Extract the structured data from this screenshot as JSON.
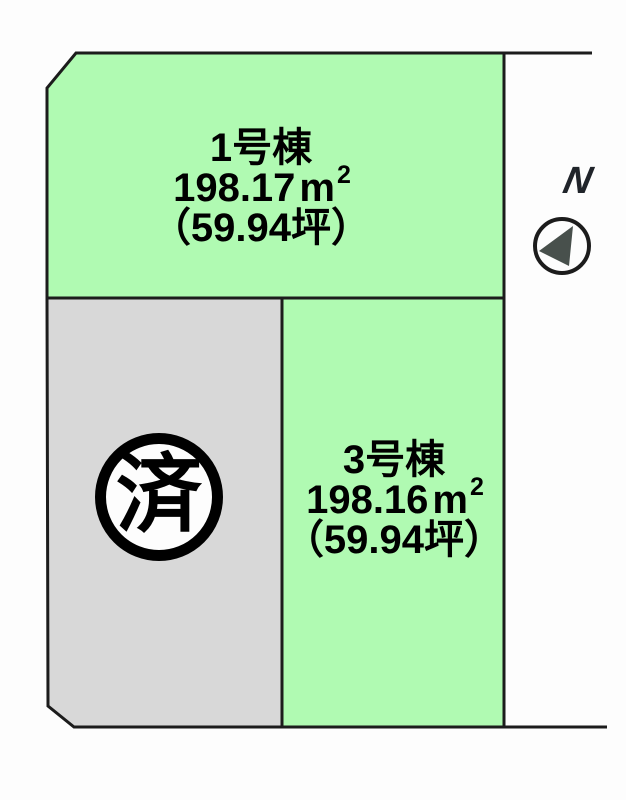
{
  "plan": {
    "lots": {
      "lot1": {
        "name": "1号棟",
        "area_value": "198.17",
        "area_unit": "m",
        "area_sup": "2",
        "tsubo": "（59.94坪）"
      },
      "lot3": {
        "name": "3号棟",
        "area_value": "198.16",
        "area_unit": "m",
        "area_sup": "2",
        "tsubo": "（59.94坪）"
      },
      "sold_lot": {
        "badge": "済"
      }
    },
    "compass": {
      "north_label": "N"
    }
  },
  "colors": {
    "lot_green": "#b0fab2",
    "lot_sold_gray": "#d8d8d8",
    "outline": "#1c1c1c",
    "compass_needle": "#48504c",
    "badge_background": "#fdfdfd",
    "background": "#fdfdfd"
  }
}
